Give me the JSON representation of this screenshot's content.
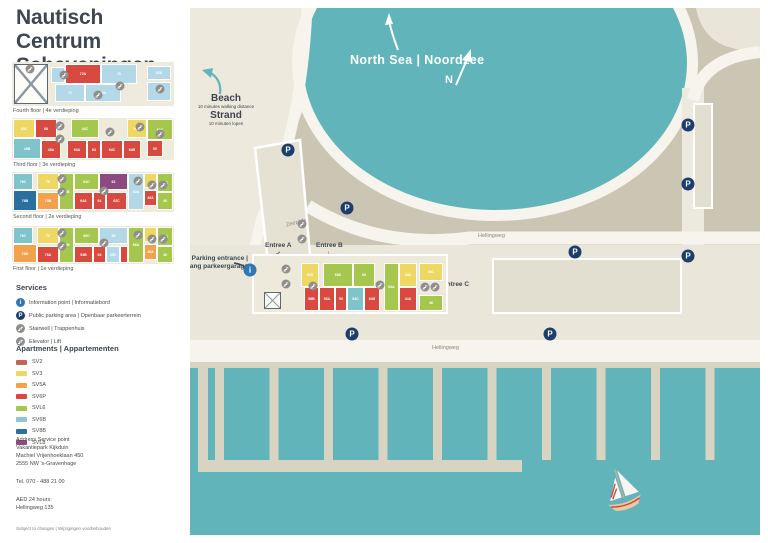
{
  "title": {
    "line1": "Nautisch Centrum",
    "line2": "Scheveningen"
  },
  "colors": {
    "water": "#61b4ba",
    "sand_light": "#edeadd",
    "sand_mid": "#cbc5b4",
    "parking_lot": "#eae7da",
    "road": "#f6f4ec",
    "pier": "#d9d3c2",
    "building": "#e3dfd0",
    "navy": "#1d3e6d",
    "info_blue": "#2f77b5",
    "icon_gray": "#8f8e8a",
    "text_dark": "#3e4651",
    "units": {
      "cr": "#d8493f",
      "sv2": "#c2635c",
      "yellow": "#eed763",
      "orange": "#f2a24d",
      "green": "#a5c74d",
      "teal": "#7fc3cb",
      "blue": "#2b6f9e",
      "purple": "#8d4a80",
      "lb": "#b3d9e9"
    }
  },
  "floors": [
    {
      "label": "Fourth floor | 4e verdieping",
      "top": 62,
      "h": 44,
      "label_y": 108,
      "hatch": {
        "x": 2,
        "y": 2,
        "w": 34,
        "h": 40
      },
      "units": [
        {
          "x": 40,
          "y": 6,
          "w": 12,
          "h": 14,
          "c": "lb",
          "t": ""
        },
        {
          "x": 54,
          "y": 3,
          "w": 34,
          "h": 18,
          "c": "cr",
          "t": "72A"
        },
        {
          "x": 90,
          "y": 3,
          "w": 34,
          "h": 18,
          "c": "lb",
          "t": "70"
        },
        {
          "x": 136,
          "y": 5,
          "w": 22,
          "h": 12,
          "c": "lb",
          "t": "02A"
        },
        {
          "x": 44,
          "y": 23,
          "w": 28,
          "h": 16,
          "c": "lb",
          "t": "72"
        },
        {
          "x": 74,
          "y": 23,
          "w": 34,
          "h": 16,
          "c": "lb",
          "t": "70A"
        },
        {
          "x": 136,
          "y": 21,
          "w": 22,
          "h": 17,
          "c": "lb",
          "t": "02"
        }
      ],
      "icons": [
        {
          "x": 18,
          "y": 7
        },
        {
          "x": 52,
          "y": 13
        },
        {
          "x": 86,
          "y": 33
        },
        {
          "x": 108,
          "y": 24
        },
        {
          "x": 148,
          "y": 27
        }
      ]
    },
    {
      "label": "Third floor | 3e verdieping",
      "top": 118,
      "h": 42,
      "label_y": 162,
      "hatch": null,
      "units": [
        {
          "x": 2,
          "y": 2,
          "w": 20,
          "h": 17,
          "c": "yellow",
          "t": "68C"
        },
        {
          "x": 24,
          "y": 2,
          "w": 20,
          "h": 17,
          "c": "cr",
          "t": "68"
        },
        {
          "x": 60,
          "y": 2,
          "w": 26,
          "h": 17,
          "c": "green",
          "t": "44C"
        },
        {
          "x": 116,
          "y": 2,
          "w": 18,
          "h": 17,
          "c": "yellow",
          "t": "68A"
        },
        {
          "x": 136,
          "y": 2,
          "w": 24,
          "h": 19,
          "c": "green",
          "t": "60C"
        },
        {
          "x": 2,
          "y": 21,
          "w": 26,
          "h": 19,
          "c": "teal",
          "t": "45B"
        },
        {
          "x": 30,
          "y": 23,
          "w": 18,
          "h": 17,
          "c": "cr",
          "t": "45A"
        },
        {
          "x": 56,
          "y": 23,
          "w": 18,
          "h": 17,
          "c": "cr",
          "t": "64A"
        },
        {
          "x": 76,
          "y": 23,
          "w": 12,
          "h": 17,
          "c": "cr",
          "t": "64"
        },
        {
          "x": 90,
          "y": 23,
          "w": 20,
          "h": 17,
          "c": "cr",
          "t": "64C"
        },
        {
          "x": 112,
          "y": 23,
          "w": 16,
          "h": 17,
          "c": "cr",
          "t": "64B"
        },
        {
          "x": 136,
          "y": 23,
          "w": 14,
          "h": 15,
          "c": "cr",
          "t": "50"
        }
      ],
      "icons": [
        {
          "x": 48,
          "y": 8
        },
        {
          "x": 48,
          "y": 21
        },
        {
          "x": 98,
          "y": 14
        },
        {
          "x": 128,
          "y": 9
        },
        {
          "x": 148,
          "y": 16
        }
      ]
    },
    {
      "label": "Second floor | 2e verdieping",
      "top": 172,
      "h": 40,
      "label_y": 214,
      "hatch": null,
      "units": [
        {
          "x": 2,
          "y": 2,
          "w": 18,
          "h": 15,
          "c": "teal",
          "t": "76C"
        },
        {
          "x": 26,
          "y": 2,
          "w": 20,
          "h": 15,
          "c": "yellow",
          "t": "76"
        },
        {
          "x": 48,
          "y": 2,
          "w": 13,
          "h": 35,
          "c": "green",
          "t": "64B"
        },
        {
          "x": 63,
          "y": 2,
          "w": 23,
          "h": 15,
          "c": "green",
          "t": "64C"
        },
        {
          "x": 88,
          "y": 2,
          "w": 27,
          "h": 15,
          "c": "purple",
          "t": "62"
        },
        {
          "x": 117,
          "y": 2,
          "w": 14,
          "h": 35,
          "c": "lb",
          "t": "62A"
        },
        {
          "x": 133,
          "y": 2,
          "w": 11,
          "h": 13,
          "c": "yellow",
          "t": ""
        },
        {
          "x": 146,
          "y": 2,
          "w": 14,
          "h": 17,
          "c": "green",
          "t": "44C"
        },
        {
          "x": 2,
          "y": 19,
          "w": 22,
          "h": 19,
          "c": "blue",
          "t": "76B"
        },
        {
          "x": 26,
          "y": 21,
          "w": 20,
          "h": 16,
          "c": "orange",
          "t": "78B"
        },
        {
          "x": 63,
          "y": 21,
          "w": 17,
          "h": 16,
          "c": "cr",
          "t": "64A"
        },
        {
          "x": 82,
          "y": 21,
          "w": 11,
          "h": 16,
          "c": "cr",
          "t": "64"
        },
        {
          "x": 95,
          "y": 21,
          "w": 19,
          "h": 16,
          "c": "cr",
          "t": "62C"
        },
        {
          "x": 133,
          "y": 19,
          "w": 11,
          "h": 14,
          "c": "cr",
          "t": "46A"
        },
        {
          "x": 146,
          "y": 21,
          "w": 14,
          "h": 16,
          "c": "green",
          "t": "46"
        }
      ],
      "icons": [
        {
          "x": 50,
          "y": 7
        },
        {
          "x": 50,
          "y": 20
        },
        {
          "x": 92,
          "y": 19
        },
        {
          "x": 126,
          "y": 9
        },
        {
          "x": 140,
          "y": 13
        },
        {
          "x": 151,
          "y": 13
        }
      ]
    },
    {
      "label": "First floor | 1e verdieping",
      "top": 226,
      "h": 38,
      "label_y": 266,
      "hatch": null,
      "units": [
        {
          "x": 2,
          "y": 2,
          "w": 18,
          "h": 15,
          "c": "teal",
          "t": "76C"
        },
        {
          "x": 26,
          "y": 2,
          "w": 20,
          "h": 15,
          "c": "yellow",
          "t": "76"
        },
        {
          "x": 48,
          "y": 2,
          "w": 13,
          "h": 34,
          "c": "green",
          "t": "61B"
        },
        {
          "x": 63,
          "y": 2,
          "w": 23,
          "h": 15,
          "c": "green",
          "t": "66C"
        },
        {
          "x": 88,
          "y": 2,
          "w": 27,
          "h": 15,
          "c": "lb",
          "t": "58"
        },
        {
          "x": 117,
          "y": 2,
          "w": 14,
          "h": 34,
          "c": "green",
          "t": "66A"
        },
        {
          "x": 133,
          "y": 2,
          "w": 11,
          "h": 13,
          "c": "yellow",
          "t": ""
        },
        {
          "x": 146,
          "y": 2,
          "w": 14,
          "h": 17,
          "c": "green",
          "t": "44C"
        },
        {
          "x": 2,
          "y": 19,
          "w": 22,
          "h": 17,
          "c": "orange",
          "t": "78B"
        },
        {
          "x": 26,
          "y": 21,
          "w": 20,
          "h": 15,
          "c": "cr",
          "t": "78A"
        },
        {
          "x": 63,
          "y": 21,
          "w": 17,
          "h": 15,
          "c": "cr",
          "t": "54B"
        },
        {
          "x": 82,
          "y": 21,
          "w": 11,
          "h": 15,
          "c": "cr",
          "t": "54"
        },
        {
          "x": 95,
          "y": 21,
          "w": 12,
          "h": 15,
          "c": "lb",
          "t": "58C"
        },
        {
          "x": 109,
          "y": 21,
          "w": 6,
          "h": 15,
          "c": "cr",
          "t": ""
        },
        {
          "x": 133,
          "y": 19,
          "w": 11,
          "h": 14,
          "c": "orange",
          "t": "46A"
        },
        {
          "x": 146,
          "y": 21,
          "w": 14,
          "h": 15,
          "c": "green",
          "t": "46"
        }
      ],
      "icons": [
        {
          "x": 50,
          "y": 7
        },
        {
          "x": 50,
          "y": 20
        },
        {
          "x": 92,
          "y": 17
        },
        {
          "x": 126,
          "y": 9
        },
        {
          "x": 140,
          "y": 13
        },
        {
          "x": 151,
          "y": 13
        }
      ]
    }
  ],
  "services": {
    "heading": "Services",
    "items": [
      {
        "icon": "info",
        "label": "Information point | Informatiebord"
      },
      {
        "icon": "parking",
        "label": "Public parking area | Openbaar parkeerterrein"
      },
      {
        "icon": "stairs",
        "label": "Stairwell | Trappenhuis"
      },
      {
        "icon": "elevator",
        "label": "Elevator | Lift"
      }
    ]
  },
  "legend": {
    "heading": "Apartments | Appartementen",
    "items": [
      {
        "code": "SV2",
        "color": "#c2635c"
      },
      {
        "code": "SV3",
        "color": "#eed763"
      },
      {
        "code": "SV5A",
        "color": "#f2a24d"
      },
      {
        "code": "SV6P",
        "color": "#d8493f"
      },
      {
        "code": "SVL6",
        "color": "#a5c74d"
      },
      {
        "code": "SV6B",
        "color": "#8ec7cd"
      },
      {
        "code": "SV8B",
        "color": "#2b6f9e"
      },
      {
        "code": "SVL8",
        "color": "#8d4a80"
      }
    ]
  },
  "address": {
    "lines": [
      "Address Service point",
      "Vakantiepark Kijkduin",
      "Machiel Vrijenhoeklaan 450",
      "2555 NW 's-Gravenhage"
    ],
    "tel": "Tel. 070 - 488 21 00",
    "aed": [
      "AED 24 hours:",
      "Hellingweg 135"
    ],
    "disclaimer": "Subject to changes | Wijzigingen voorbehouden"
  },
  "map": {
    "sea_label": "North Sea | Noordzee",
    "compass": "N",
    "beach": {
      "l1": "Beach",
      "l2": "10 minutes walking distance",
      "l3": "Strand",
      "l4": "10 minuten lopen"
    },
    "parking_entrance": {
      "l1": "Parking entrance |",
      "l2": "Ingang parkeergarage"
    },
    "entrances": {
      "a": "Entree A",
      "b": "Entree B",
      "c": "Entree C",
      "a_arrow": "↙",
      "b_arrow": "↓",
      "c_arrow": "←"
    },
    "ground_label": "Ground floor | Begane grond",
    "streets": {
      "zeezijde": "Zeezijde",
      "hellingweg": "Hellingweg"
    },
    "p_letter": "P",
    "i_letter": "i",
    "p_icons": [
      {
        "x": 98,
        "y": 142
      },
      {
        "x": 157,
        "y": 200
      },
      {
        "x": 385,
        "y": 244
      },
      {
        "x": 498,
        "y": 117
      },
      {
        "x": 498,
        "y": 176
      },
      {
        "x": 498,
        "y": 248
      },
      {
        "x": 162,
        "y": 326
      },
      {
        "x": 360,
        "y": 326
      }
    ],
    "info_icon": {
      "x": 60,
      "y": 262
    },
    "gray_icons": [
      {
        "x": 112,
        "y": 216
      },
      {
        "x": 112,
        "y": 231
      }
    ],
    "ground_hatch": {
      "x": 10,
      "y": 36,
      "w": 17,
      "h": 17
    },
    "ground_units": [
      {
        "x": 48,
        "y": 8,
        "w": 16,
        "h": 22,
        "c": "yellow",
        "t": "64D"
      },
      {
        "x": 70,
        "y": 8,
        "w": 28,
        "h": 22,
        "c": "green",
        "t": "66D"
      },
      {
        "x": 100,
        "y": 8,
        "w": 20,
        "h": 22,
        "c": "green",
        "t": "66"
      },
      {
        "x": 131,
        "y": 8,
        "w": 13,
        "h": 46,
        "c": "green",
        "t": "64A"
      },
      {
        "x": 146,
        "y": 8,
        "w": 16,
        "h": 22,
        "c": "yellow",
        "t": "44D"
      },
      {
        "x": 166,
        "y": 8,
        "w": 22,
        "h": 16,
        "c": "yellow",
        "t": "44C"
      },
      {
        "x": 51,
        "y": 32,
        "w": 13,
        "h": 22,
        "c": "cr",
        "t": "56B"
      },
      {
        "x": 66,
        "y": 32,
        "w": 14,
        "h": 22,
        "c": "cr",
        "t": "56A"
      },
      {
        "x": 82,
        "y": 32,
        "w": 10,
        "h": 22,
        "c": "cr",
        "t": "56"
      },
      {
        "x": 94,
        "y": 32,
        "w": 15,
        "h": 22,
        "c": "teal",
        "t": "54C"
      },
      {
        "x": 111,
        "y": 32,
        "w": 14,
        "h": 22,
        "c": "cr",
        "t": "64B"
      },
      {
        "x": 146,
        "y": 32,
        "w": 16,
        "h": 22,
        "c": "cr",
        "t": "44A"
      },
      {
        "x": 166,
        "y": 40,
        "w": 22,
        "h": 14,
        "c": "green",
        "t": "46"
      }
    ],
    "ground_icons": [
      {
        "x": 32,
        "y": 13
      },
      {
        "x": 32,
        "y": 28
      },
      {
        "x": 59,
        "y": 30
      },
      {
        "x": 126,
        "y": 29
      },
      {
        "x": 171,
        "y": 31
      },
      {
        "x": 181,
        "y": 31
      }
    ],
    "piers": {
      "left_edge": {
        "x": 8,
        "y": 360,
        "w": 10,
        "h": 104
      },
      "count": 10,
      "x0": 25,
      "gap": 54.5,
      "w": 9,
      "y": 360,
      "h": 92,
      "horizontal": {
        "x": 14,
        "y": 452,
        "w": 318,
        "h": 12
      }
    }
  }
}
